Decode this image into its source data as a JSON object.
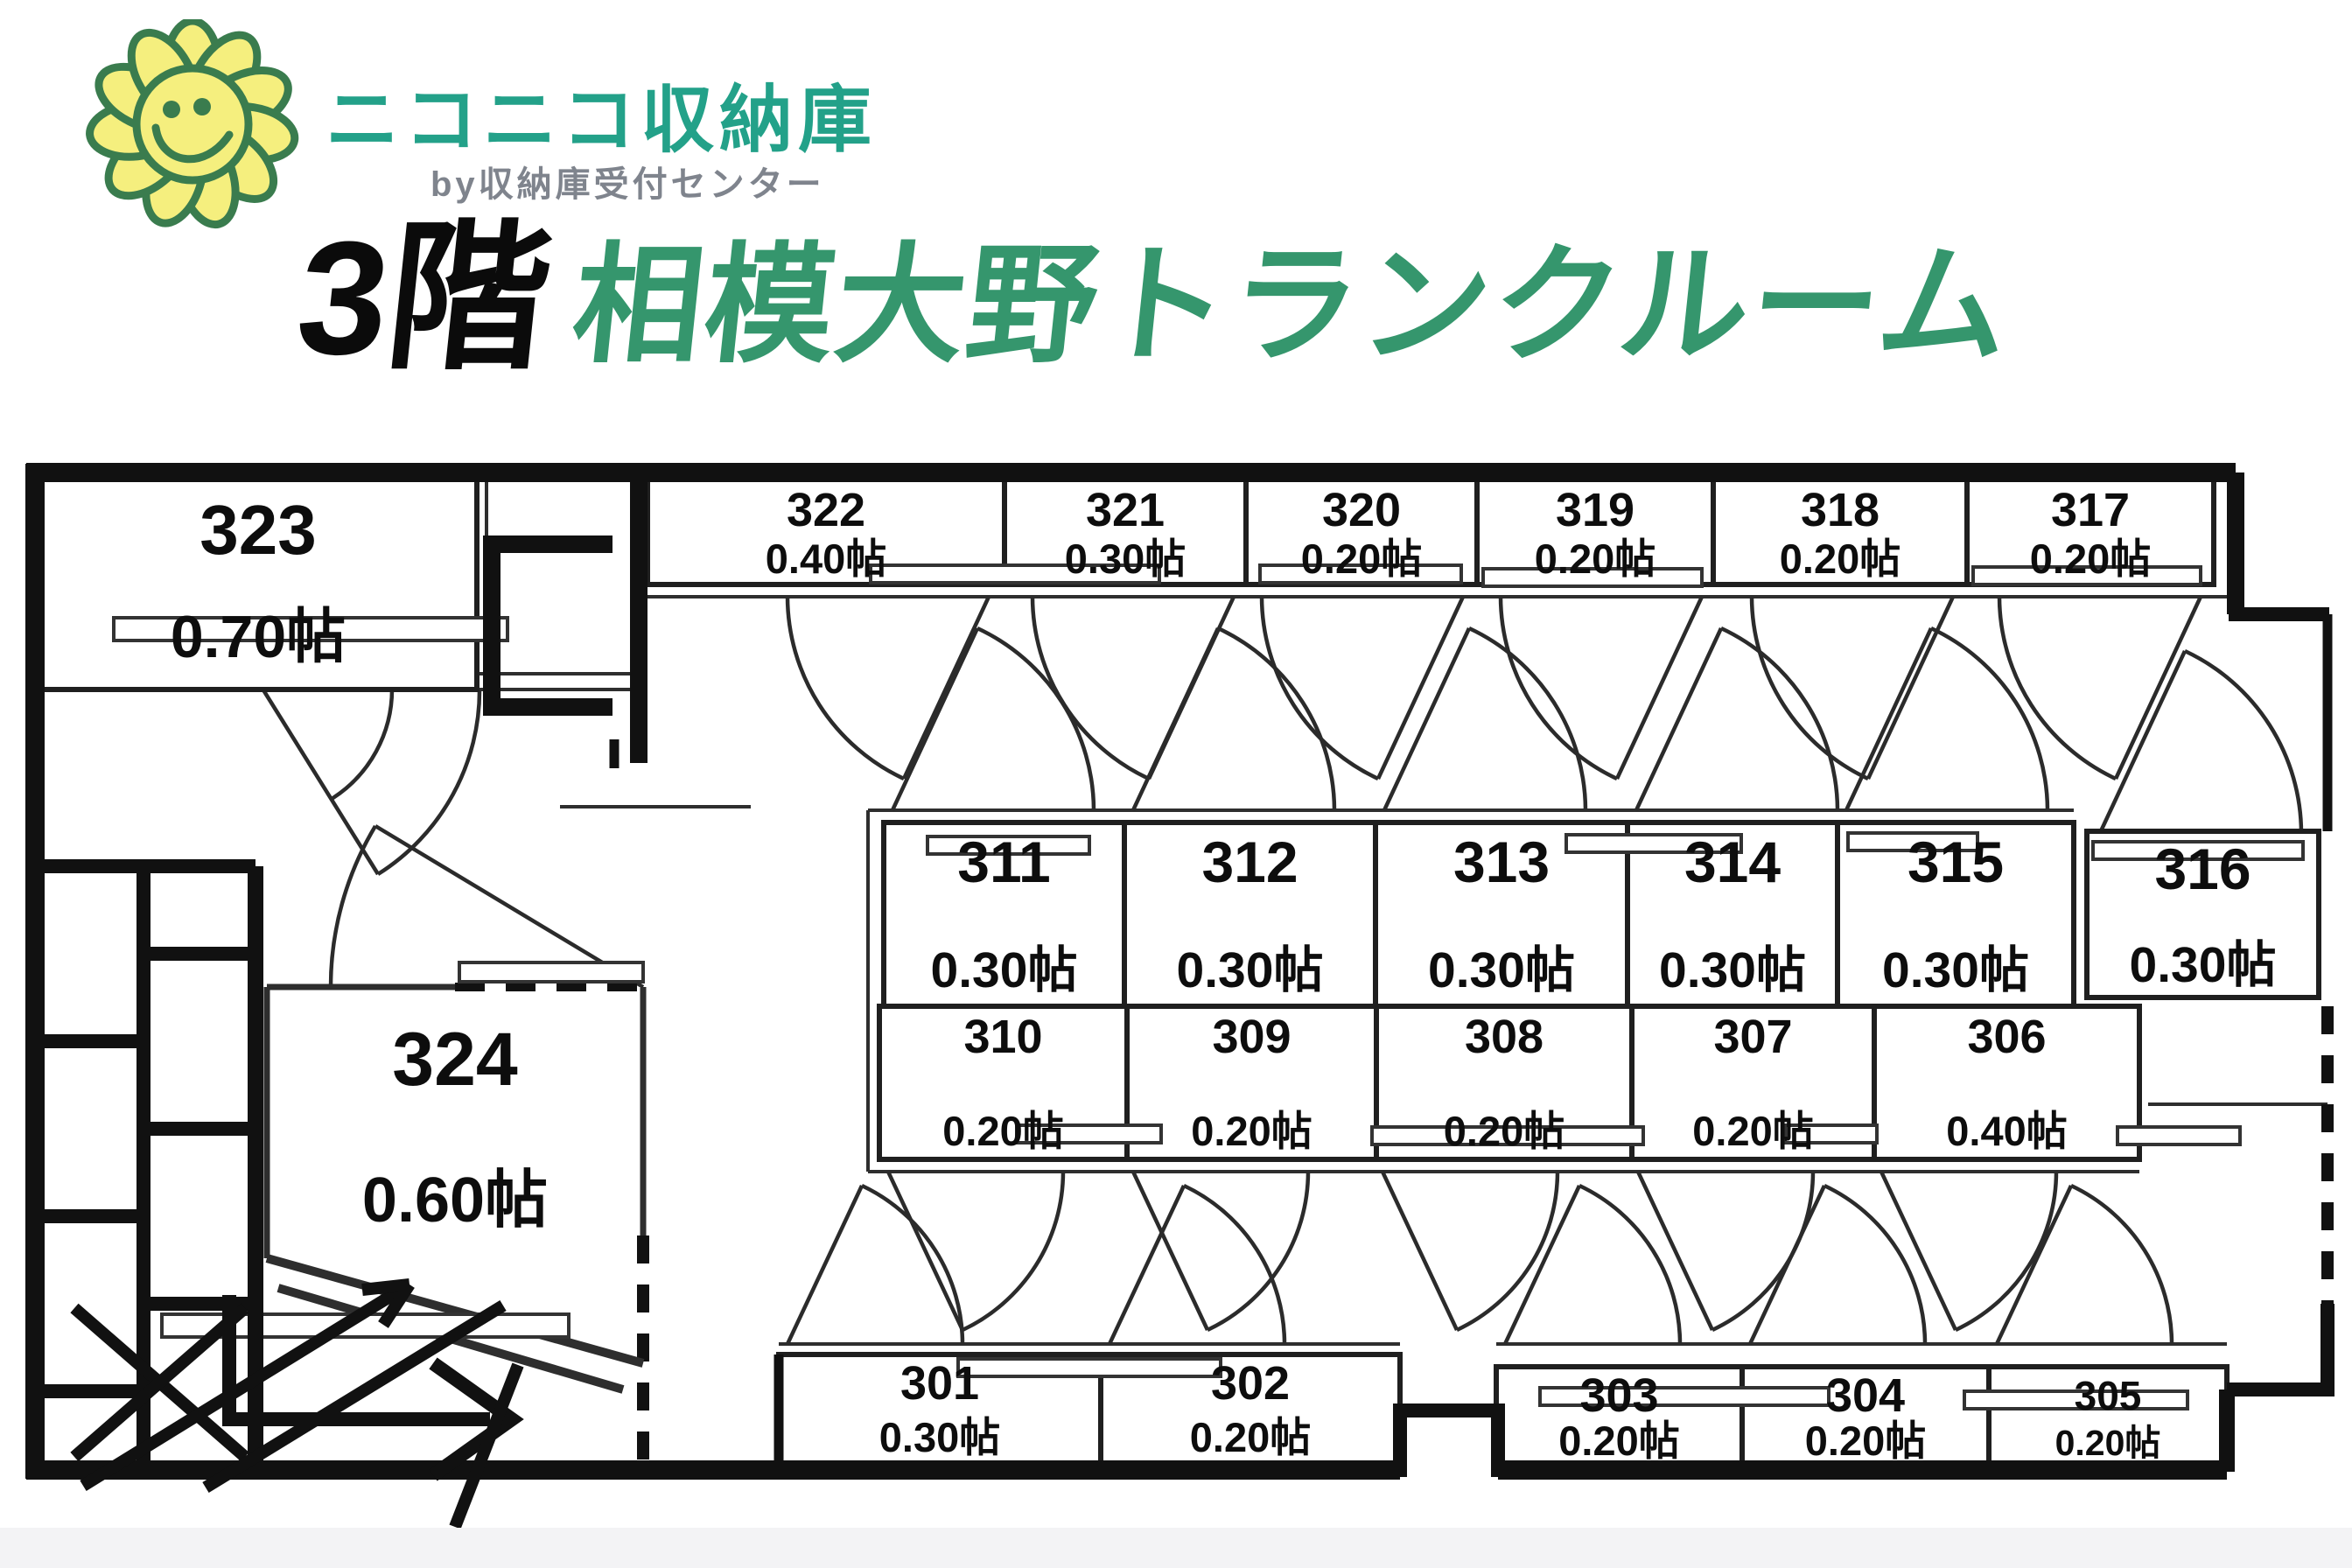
{
  "logo": {
    "brand": "ニコニコ収納庫",
    "sub": "by収納庫受付センター",
    "icon": "sunflower-smiley"
  },
  "header": {
    "floor": "3階",
    "title": "相模大野トランクルーム"
  },
  "colors": {
    "brand_green": "#23a189",
    "title_green": "#35966d",
    "sub_gray": "#7f848d",
    "flower_yellow": "#f5ef7e",
    "flower_outline": "#3a7c4e",
    "line_black": "#111111"
  },
  "rooms": {
    "r301": {
      "number": "301",
      "size": "0.30帖"
    },
    "r302": {
      "number": "302",
      "size": "0.20帖"
    },
    "r303": {
      "number": "303",
      "size": "0.20帖"
    },
    "r304": {
      "number": "304",
      "size": "0.20帖"
    },
    "r305": {
      "number": "305",
      "size": "0.20帖"
    },
    "r306": {
      "number": "306",
      "size": "0.40帖"
    },
    "r307": {
      "number": "307",
      "size": "0.20帖"
    },
    "r308": {
      "number": "308",
      "size": "0.20帖"
    },
    "r309": {
      "number": "309",
      "size": "0.20帖"
    },
    "r310": {
      "number": "310",
      "size": "0.20帖"
    },
    "r311": {
      "number": "311",
      "size": "0.30帖"
    },
    "r312": {
      "number": "312",
      "size": "0.30帖"
    },
    "r313": {
      "number": "313",
      "size": "0.30帖"
    },
    "r314": {
      "number": "314",
      "size": "0.30帖"
    },
    "r315": {
      "number": "315",
      "size": "0.30帖"
    },
    "r316": {
      "number": "316",
      "size": "0.30帖"
    },
    "r317": {
      "number": "317",
      "size": "0.20帖"
    },
    "r318": {
      "number": "318",
      "size": "0.20帖"
    },
    "r319": {
      "number": "319",
      "size": "0.20帖"
    },
    "r320": {
      "number": "320",
      "size": "0.20帖"
    },
    "r321": {
      "number": "321",
      "size": "0.30帖"
    },
    "r322": {
      "number": "322",
      "size": "0.40帖"
    },
    "r323": {
      "number": "323",
      "size": "0.70帖"
    },
    "r324": {
      "number": "324",
      "size": "0.60帖"
    }
  }
}
